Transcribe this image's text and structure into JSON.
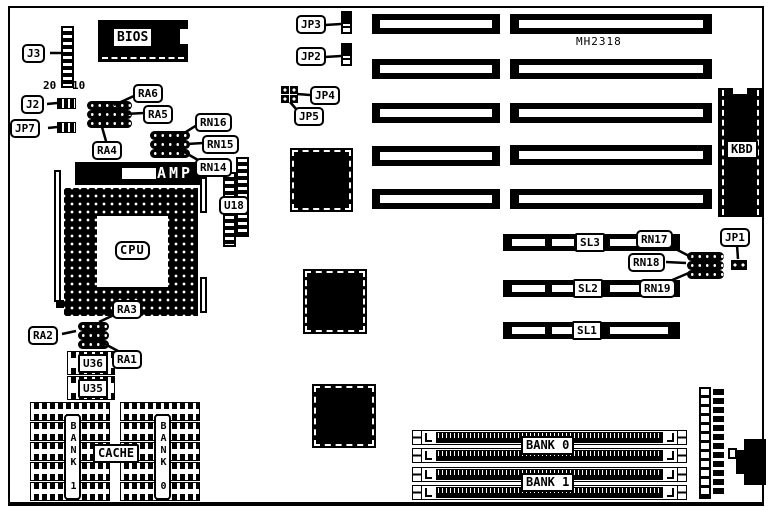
{
  "diagram": {
    "board_model": "MH2318",
    "socket_brand": "AMP",
    "pin_numbers": {
      "left": "20",
      "right": "10"
    },
    "callouts": {
      "j1": "JP1",
      "j2": "J2",
      "j3": "J3",
      "jp2": "JP2",
      "jp3": "JP3",
      "jp4": "JP4",
      "jp5": "JP5",
      "jp7": "JP7",
      "ra1": "RA1",
      "ra2": "RA2",
      "ra3": "RA3",
      "ra4": "RA4",
      "ra5": "RA5",
      "ra6": "RA6",
      "rn14": "RN14",
      "rn15": "RN15",
      "rn16": "RN16",
      "rn17": "RN17",
      "rn18": "RN18",
      "rn19": "RN19",
      "u18": "U18",
      "u35": "U35",
      "u36": "U36"
    },
    "chips": {
      "bios": "BIOS",
      "cpu": "CPU",
      "kbd": "KBD"
    },
    "slots": {
      "sl1": "SL1",
      "sl2": "SL2",
      "sl3": "SL3"
    },
    "memory": {
      "simm_bank0": "BANK 0",
      "simm_bank1": "BANK 1",
      "cache_label": "CACHE",
      "cache_bank0": "BANK 0",
      "cache_bank1": "BANK 1"
    },
    "colors": {
      "ink": "#000000",
      "paper": "#ffffff"
    }
  }
}
